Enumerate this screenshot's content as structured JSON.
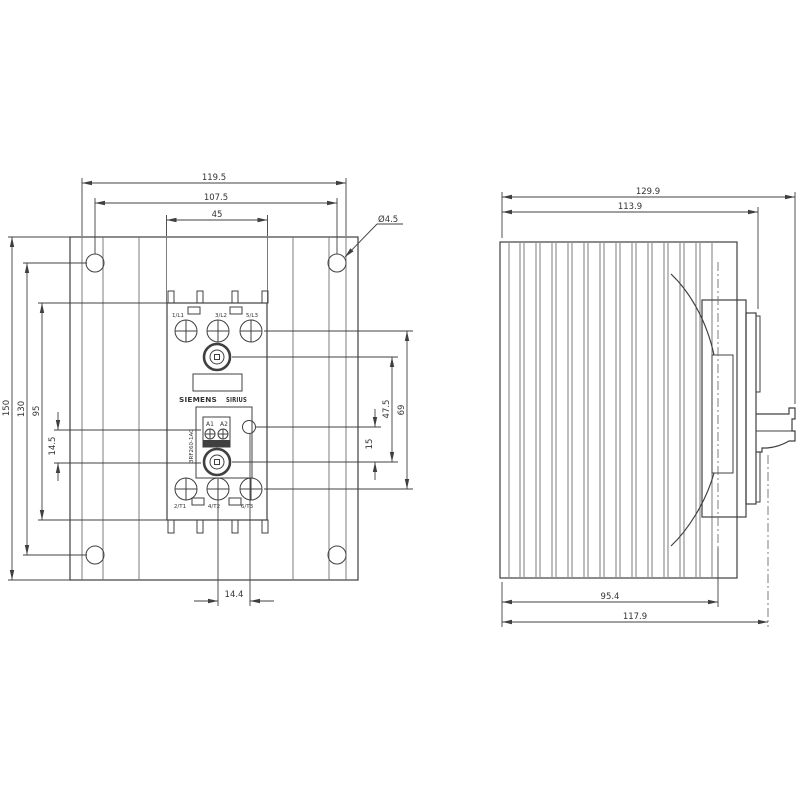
{
  "front_view": {
    "device": {
      "brand": "SIEMENS",
      "series": "SIRIUS",
      "part_number": "3RF260-1AC",
      "terminals_top": [
        "1/L1",
        "3/L2",
        "5/L3"
      ],
      "terminals_bottom": [
        "2/T1",
        "4/T2",
        "6/T3"
      ],
      "coil_terminals": [
        "A1",
        "A2"
      ]
    },
    "dimensions": {
      "overall_width": "119.5",
      "mounting_hole_spacing_horizontal": "107.5",
      "device_width": "45",
      "mounting_hole_diameter": "Ø4.5",
      "overall_height": "150",
      "mounting_hole_spacing_vertical": "130",
      "device_height": "95",
      "coil_block_offset": "14.5",
      "terminal_row_spacing": "69",
      "screw_spacing": "47.5",
      "indicator_offset": "15",
      "indicator_center_offset": "14.4"
    }
  },
  "side_view": {
    "dimensions": {
      "overall_width": "129.9",
      "body_width": "113.9",
      "heatsink_depth": "95.4",
      "overall_depth": "117.9"
    }
  },
  "colors": {
    "line": "#404040",
    "fin_line": "#6f6f6f",
    "text": "#333333",
    "background": "#ffffff"
  }
}
